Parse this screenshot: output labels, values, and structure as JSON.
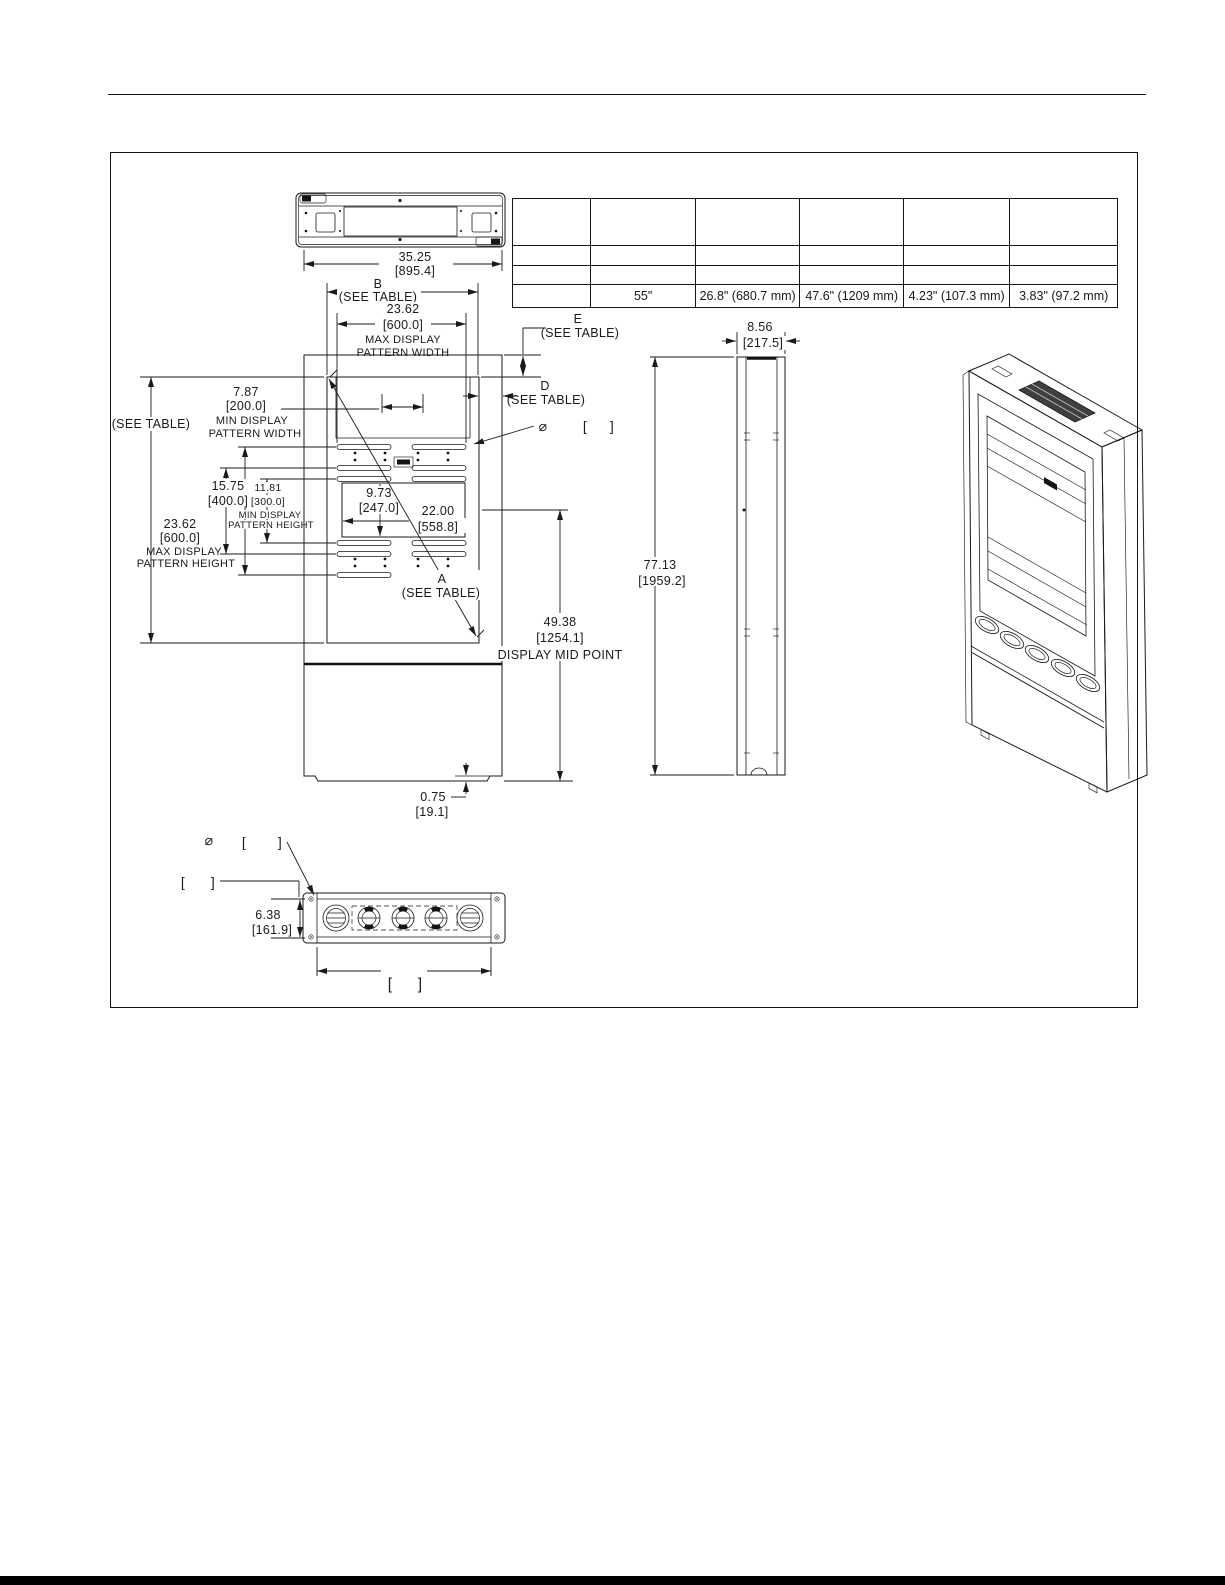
{
  "spec_table": {
    "row4": [
      "",
      "55\"",
      "26.8\" (680.7 mm)",
      "47.6\" (1209 mm)",
      "4.23\" (107.3 mm)",
      "3.83\" (97.2 mm)"
    ]
  },
  "labels": {
    "see_table": "(SEE TABLE)",
    "dia": "⌀",
    "lb": "[",
    "rb": "]",
    "overall_w": "35.25",
    "overall_w_mm": "[895.4]",
    "b": "B",
    "e": "E",
    "d": "D",
    "a": "A",
    "w600": "23.62",
    "w600_mm": "[600.0]",
    "max_display": "MAX DISPLAY",
    "min_display": "MIN DISPLAY",
    "pattern_width": "PATTERN WIDTH",
    "pattern_height": "PATTERN HEIGHT",
    "w200": "7.87",
    "w200_mm": "[200.0]",
    "h400": "15.75",
    "h400_mm": "[400.0]",
    "h300": "11.81",
    "h300_mm": "[300.0]",
    "h247": "9.73",
    "h247_mm": "[247.0]",
    "w558": "22.00",
    "w558_mm": "[558.8]",
    "mid": "49.38",
    "mid_mm": "[1254.1]",
    "mid_label": "DISPLAY MID POINT",
    "foot": "0.75",
    "foot_mm": "[19.1]",
    "depth": "8.56",
    "depth_mm": "[217.5]",
    "tall": "77.13",
    "tall_mm": "[1959.2]",
    "bot_h": "6.38",
    "bot_h_mm": "[161.9]"
  }
}
